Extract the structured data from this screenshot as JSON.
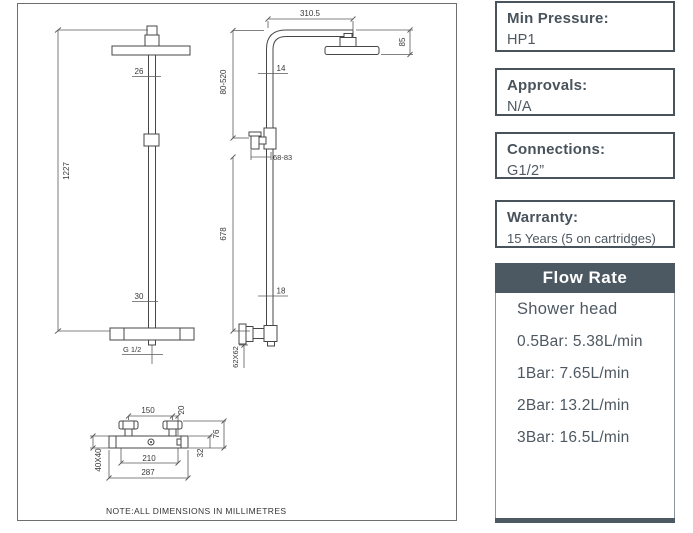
{
  "note": "NOTE:ALL DIMENSIONS IN MILLIMETRES",
  "dims": {
    "total_height": "1227",
    "pipe_upper": "26",
    "pipe_lower": "30",
    "outlet_thread": "G 1/2",
    "arm_reach": "310.5",
    "head_drop": "85",
    "riser_adjust": "80-520",
    "arm_pipe": "14",
    "bracket_depth": "68-83",
    "riser_lower": "678",
    "riser_pipe": "18",
    "wall_plate": "62X62",
    "handle_centres": "150",
    "outlet_offset": "20",
    "valve_depth": "76",
    "valve_outlet_drop": "32",
    "valve_centres": "210",
    "valve_width": "287",
    "valve_body": "40X40"
  },
  "info_boxes": [
    {
      "label": "Min Pressure:",
      "value": "HP1"
    },
    {
      "label": "Approvals:",
      "value": "N/A"
    },
    {
      "label": "Connections:",
      "value": "G1/2”"
    },
    {
      "label": "Warranty:",
      "value": "15 Years (5 on cartridges)"
    }
  ],
  "flow_rate": {
    "title": "Flow Rate",
    "subtitle": "Shower head",
    "rows": [
      "0.5Bar: 5.38L/min",
      "1Bar: 7.65L/min",
      "2Bar: 13.2L/min",
      "3Bar: 16.5L/min"
    ]
  },
  "colors": {
    "panel-accent": "#4d5962",
    "panel-text": "#4e5861",
    "panel-border": "#49535c",
    "line": "#474747"
  }
}
